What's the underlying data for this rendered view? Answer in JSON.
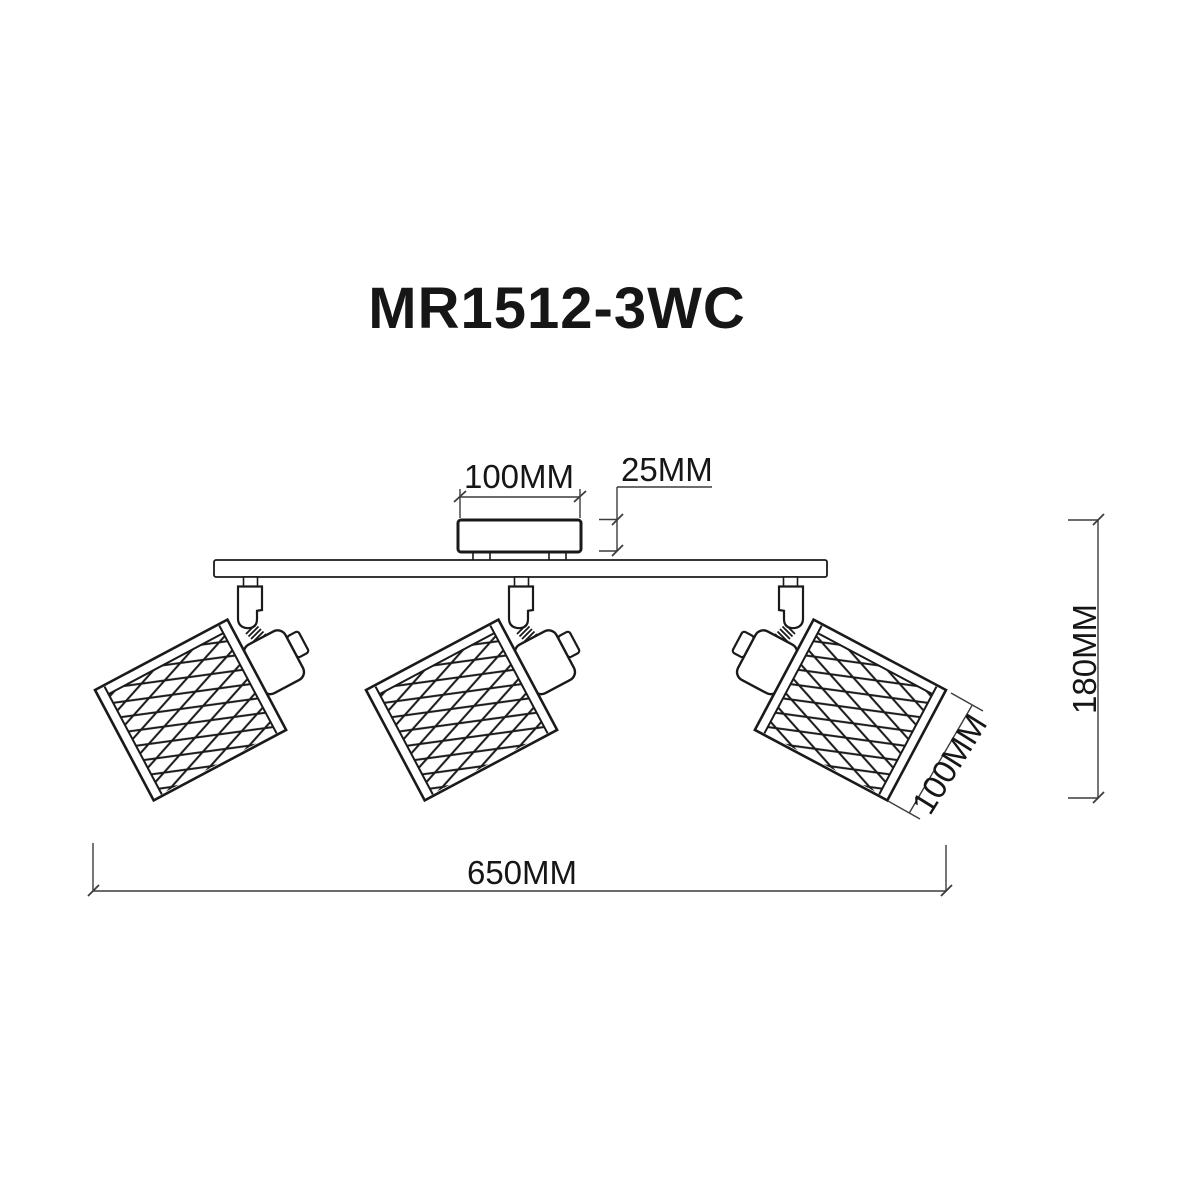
{
  "title": "MR1512-3WC",
  "drawing": {
    "type": "technical-dimension-drawing",
    "subject": "ceiling spot light fixture",
    "lamp_count": 3
  },
  "dimensions": {
    "canopy_width": "100MM",
    "canopy_height": "25MM",
    "fixture_height": "180MM",
    "fixture_length": "650MM",
    "shade_diameter": "100MM"
  },
  "colors": {
    "background": "#ffffff",
    "drawing_line": "#1a1a1a",
    "dimension_line": "#3c3c3c",
    "text": "#161616"
  }
}
